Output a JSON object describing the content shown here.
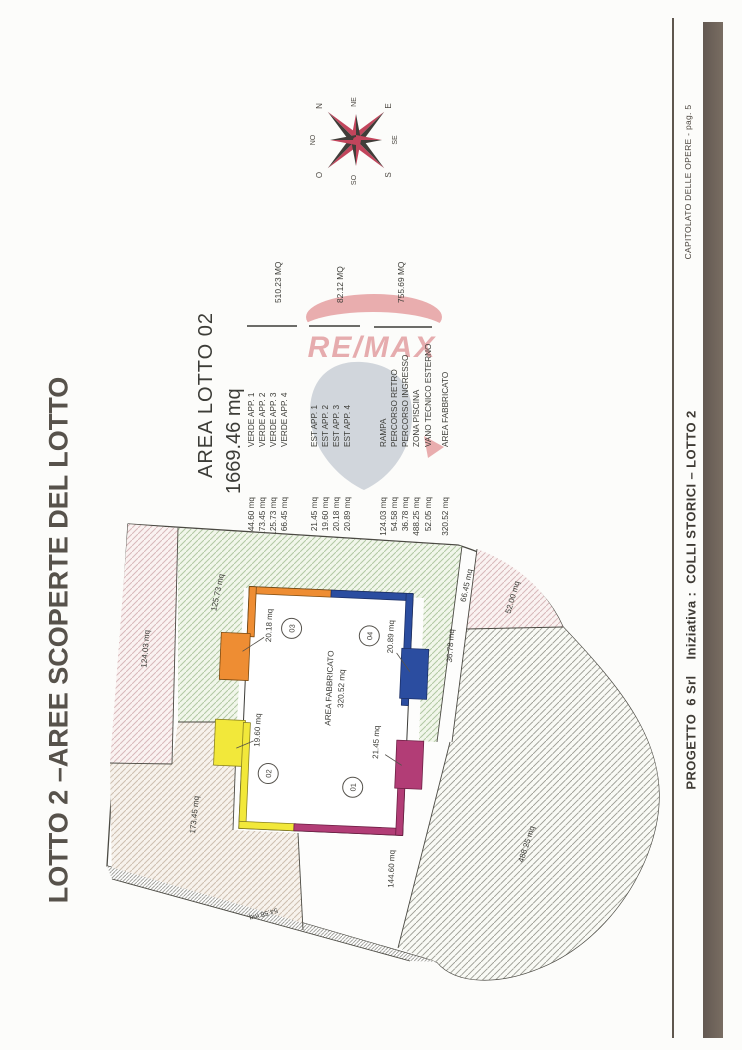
{
  "page_title": "LOTTO 2 –AREE SCOPERTE DEL LOTTO",
  "footer": {
    "doc_ref": "CAPITOLATO DELLE OPERE - pag. 5",
    "project": "PROGETTO  6 Srl    Iniziativa :  COLLI STORICI – LOTTO 2"
  },
  "watermark": {
    "brand": "RE/MAX"
  },
  "compass": {
    "n": "N",
    "ne": "NE",
    "e": "E",
    "se": "SE",
    "s": "S",
    "so": "SO",
    "o": "O",
    "no": "NO"
  },
  "legend": {
    "title": "AREA LOTTO 02",
    "total_area": "1669.46 mq",
    "groups": [
      {
        "total": "510.23 MQ",
        "rows": [
          {
            "value": "144.60 mq",
            "label": "VERDE APP. 1"
          },
          {
            "value": "173.45 mq",
            "label": "VERDE APP. 2"
          },
          {
            "value": "125.73 mq",
            "label": "VERDE APP. 3"
          },
          {
            "value": "66.45 mq",
            "label": "VERDE APP. 4"
          }
        ]
      },
      {
        "total": "82.12 MQ",
        "rows": [
          {
            "value": "21.45 mq",
            "label": "EST APP. 1"
          },
          {
            "value": "19.60 mq",
            "label": "EST APP. 2"
          },
          {
            "value": "20.18 mq",
            "label": "EST APP. 3"
          },
          {
            "value": "20.89 mq",
            "label": "EST APP. 4"
          }
        ]
      },
      {
        "total": "755.69 MQ",
        "rows": [
          {
            "value": "124.03 mq",
            "label": "RAMPA"
          },
          {
            "value": "54.58 mq",
            "label": "PERCORSO RETRO"
          },
          {
            "value": "36.78 mq",
            "label": "PERCORSO INGRESSO"
          },
          {
            "value": "488.25 mq",
            "label": "ZONA PISCINA"
          },
          {
            "value": "52.05 mq",
            "label": "VANO TECNICO ESTERNO"
          }
        ]
      },
      {
        "total": "",
        "rows": [
          {
            "value": "320.52 mq",
            "label": "AREA FABBRICATO"
          }
        ]
      }
    ]
  },
  "plan": {
    "building": {
      "label": "AREA FABBRICATO",
      "area": "320.52 mq"
    },
    "units": [
      {
        "number": "01",
        "terrace_area": "21.45 mq",
        "color": "#b23d76"
      },
      {
        "number": "02",
        "terrace_area": "19.60 mq",
        "color": "#f2e83a"
      },
      {
        "number": "03",
        "terrace_area": "20.18 mq",
        "color": "#ee8d33"
      },
      {
        "number": "04",
        "terrace_area": "20.89 mq",
        "color": "#2b4da0"
      }
    ],
    "areas": [
      {
        "name": "rampa",
        "label": "124.03 mq"
      },
      {
        "name": "verde-app-3",
        "label": "125.73 mq"
      },
      {
        "name": "verde-app-2",
        "label": "173.45 mq"
      },
      {
        "name": "verde-app-1",
        "label": "144.60 mq"
      },
      {
        "name": "verde-app-4",
        "label": "66.45 mq"
      },
      {
        "name": "percorso-ingresso",
        "label": "36.78 mq"
      },
      {
        "name": "vano-tecnico",
        "label": "52.00 mq"
      },
      {
        "name": "zona-piscina",
        "label": "488.25 mq"
      },
      {
        "name": "percorso-retro",
        "label": "54.58 mq"
      }
    ]
  }
}
